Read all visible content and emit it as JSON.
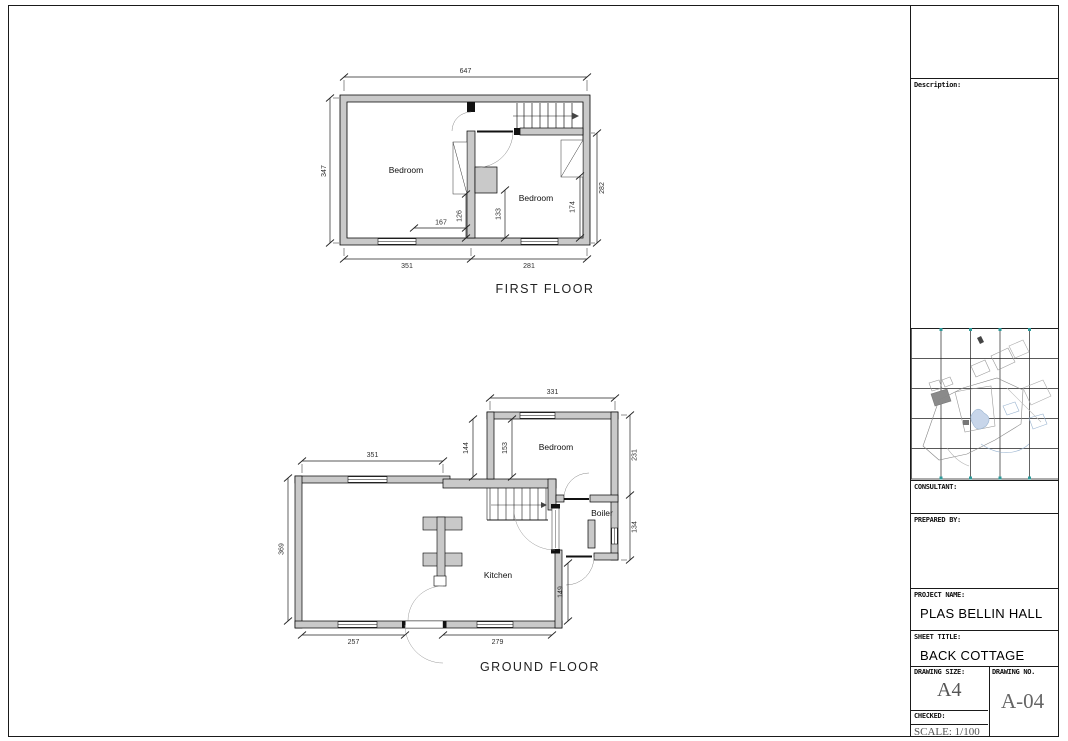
{
  "colors": {
    "wall_fill": "#c9c9c9",
    "line": "#1a1a1a",
    "dim_text": "#2f2f2f",
    "site_gray": "#999999",
    "site_blue": "#9ab4d0"
  },
  "first_floor": {
    "title": "FIRST FLOOR",
    "room_left_label": "Bedroom",
    "room_right_label": "Bedroom",
    "dims": {
      "overall_width": "647",
      "left_height": "347",
      "right_height": "282",
      "bottom_left_width": "351",
      "bottom_right_width": "281",
      "interior_width": "167",
      "interior_left_height": "126",
      "interior_mid_height": "133",
      "interior_right_height": "174"
    }
  },
  "ground_floor": {
    "title": "GROUND FLOOR",
    "bedroom_label": "Bedroom",
    "boiler_label": "Boiler",
    "kitchen_label": "Kitchen",
    "dims": {
      "wing_width": "331",
      "left_top_width": "351",
      "left_height": "369",
      "stair_gap_left": "144",
      "stair_gap_right": "153",
      "right_upper_height": "231",
      "right_lower_height": "134",
      "door_offset_height": "149",
      "bottom_left_width": "257",
      "bottom_right_width": "279"
    }
  },
  "title_block": {
    "description_label": "Description:",
    "consultant_label": "CONSULTANT:",
    "prepared_by_label": "PREPARED BY:",
    "project_name_label": "PROJECT NAME:",
    "project_name": "PLAS BELLIN HALL",
    "sheet_title_label": "SHEET TITLE:",
    "sheet_title": "BACK COTTAGE",
    "drawing_size_label": "DRAWING SIZE:",
    "drawing_size": "A4",
    "drawing_no_label": "DRAWING NO.",
    "drawing_no": "A-04",
    "checked_label": "CHECKED:",
    "scale_text": "SCALE: 1/100"
  }
}
